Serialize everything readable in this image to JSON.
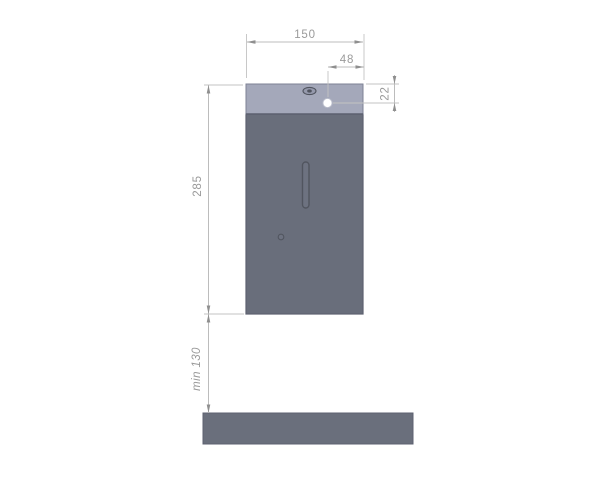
{
  "drawing": {
    "type": "technical-dimension-drawing",
    "subject": "wall-mounted dispenser front view with mounting clearance",
    "dimensions": {
      "overall_width": {
        "label": "150"
      },
      "hole_offset_from_right": {
        "label": "48"
      },
      "hole_offset_from_top": {
        "label": "22"
      },
      "overall_height": {
        "label": "285"
      },
      "bottom_clearance": {
        "label": "min 130"
      }
    },
    "colors": {
      "background": "#ffffff",
      "lid_fill": "#a4a8ba",
      "body_fill": "#696e7b",
      "outline": "#5d6170",
      "shelf_fill": "#6a6f7c",
      "hole_fill": "#ffffff",
      "dimension_line": "#bcbcbc",
      "dimension_text": "#9a9a9a",
      "arrow": "#8f8f8f"
    }
  }
}
